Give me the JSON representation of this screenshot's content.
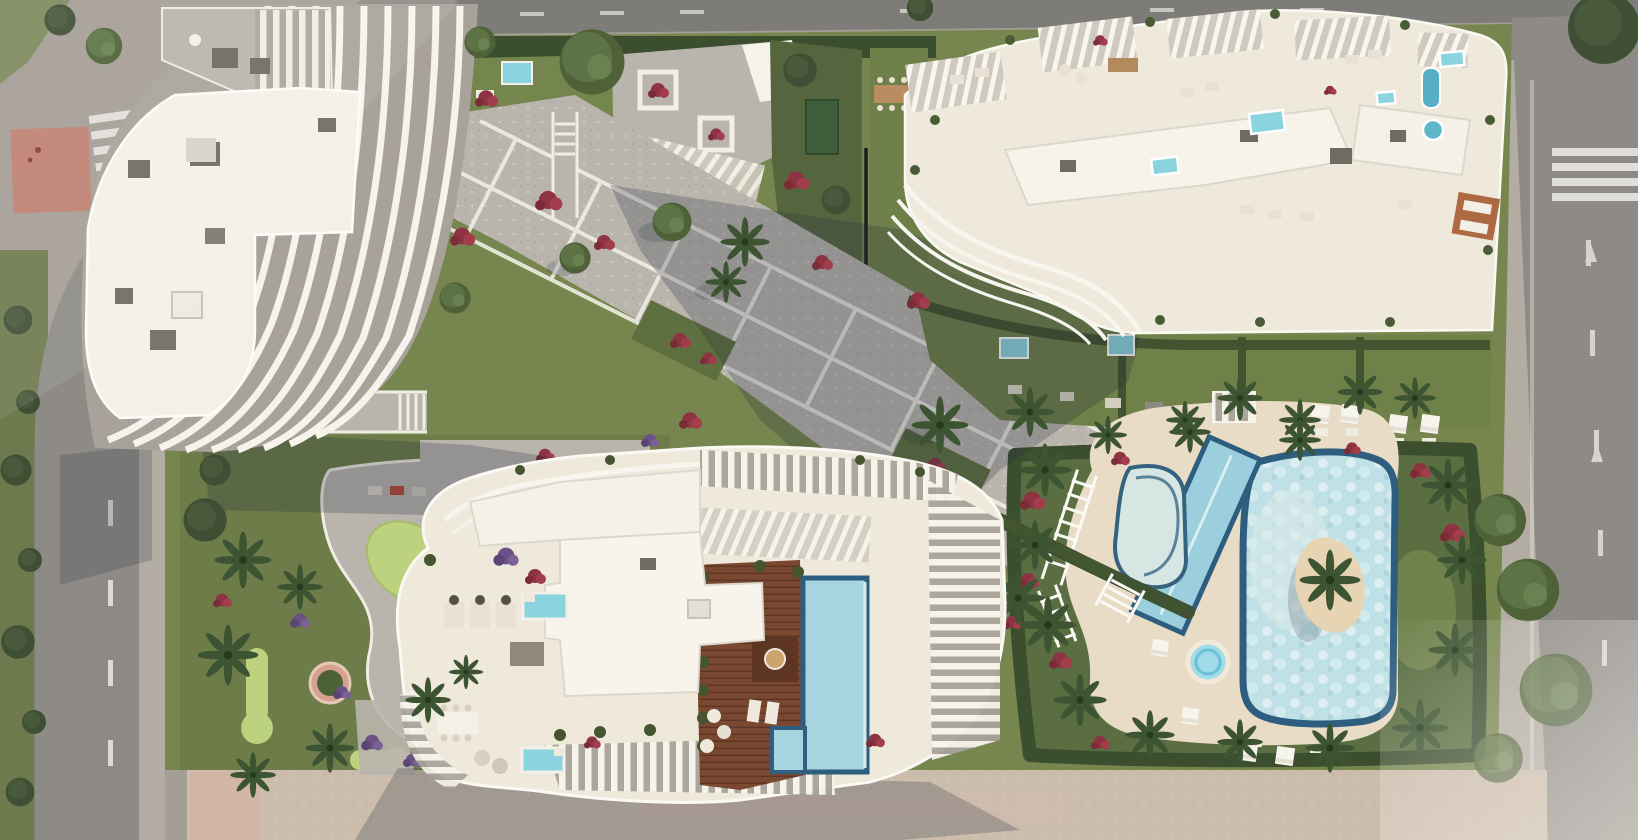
{
  "scene": {
    "title": "Aerial 3D render of a seafront residential complex",
    "description": "Bird's-eye architectural render: three white apartment buildings with sculpted curved balcony fins and rooftop terraces with plunge pools, a central paved plaza with diagonal white-edged walkways, a mini-golf garden, a rooftop wooden sun deck with an infinity lap pool, and a large lagoon-style community pool with a palm island, all set in lush gardens with palms and red flowering shrubs, bounded by asphalt roads with crosswalks on the left, top and right, and a sandy promenade along the bottom."
  },
  "palette": {
    "groundOuter": "#a49e96",
    "roadMain": "#8e8b86",
    "roadTop": "#7e7c78",
    "sidewalk": "#b2aca3",
    "pavedRed": "#c08173",
    "promenade": "#cbbcab",
    "lawn": "#77864f",
    "lawnDark": "#5f7040",
    "hedge": "#3b4e2e",
    "golfGreen": "#bcd27f",
    "plaza": "#b9b5ad",
    "pathLine": "#f2efe9",
    "roofWhite": "#f4f0e7",
    "terraceFloor": "#efe9dc",
    "finGap": "#a8a29a",
    "deckWood": "#7a4830",
    "poolWater": "#bfe0e6",
    "poolRim": "#2e5e7f",
    "poolPlunge": "#8ad4e0",
    "poolLap": "#9ccfdd",
    "poolDeck": "#e9dcc6",
    "island": "#e6d4b2",
    "flowersRed": "#8e3342",
    "flowersPurple": "#6a5186",
    "shadow": "#232a3a",
    "crosswalk": "#e9e7e2"
  },
  "elements": {
    "building_west": {
      "label": "West residence tower with curved white balcony fins"
    },
    "building_north": {
      "label": "North residence with rooftop terraces and plunge pools"
    },
    "building_south": {
      "label": "South residence with rooftop wooden deck and infinity pool"
    },
    "lagoon_pool": {
      "label": "Lagoon-style community pool with palm island"
    },
    "lap_pool": {
      "label": "Diagonal lap pool"
    },
    "kids_pool": {
      "label": "Shallow beach-entry pool"
    },
    "jacuzzi": {
      "label": "Round jacuzzi"
    },
    "sun_deck": {
      "label": "Pool sun deck with parasols and loungers"
    },
    "plaza": {
      "label": "Central paved plaza with diagonal walkway grid"
    },
    "mini_golf": {
      "label": "Mini-golf garden"
    },
    "promenade": {
      "label": "Sandy promenade"
    },
    "left_road": {
      "label": "Curved road on the west side"
    },
    "top_road": {
      "label": "Road along the north edge"
    },
    "right_road": {
      "label": "Avenue on the east side with crosswalk and lane arrows"
    }
  }
}
